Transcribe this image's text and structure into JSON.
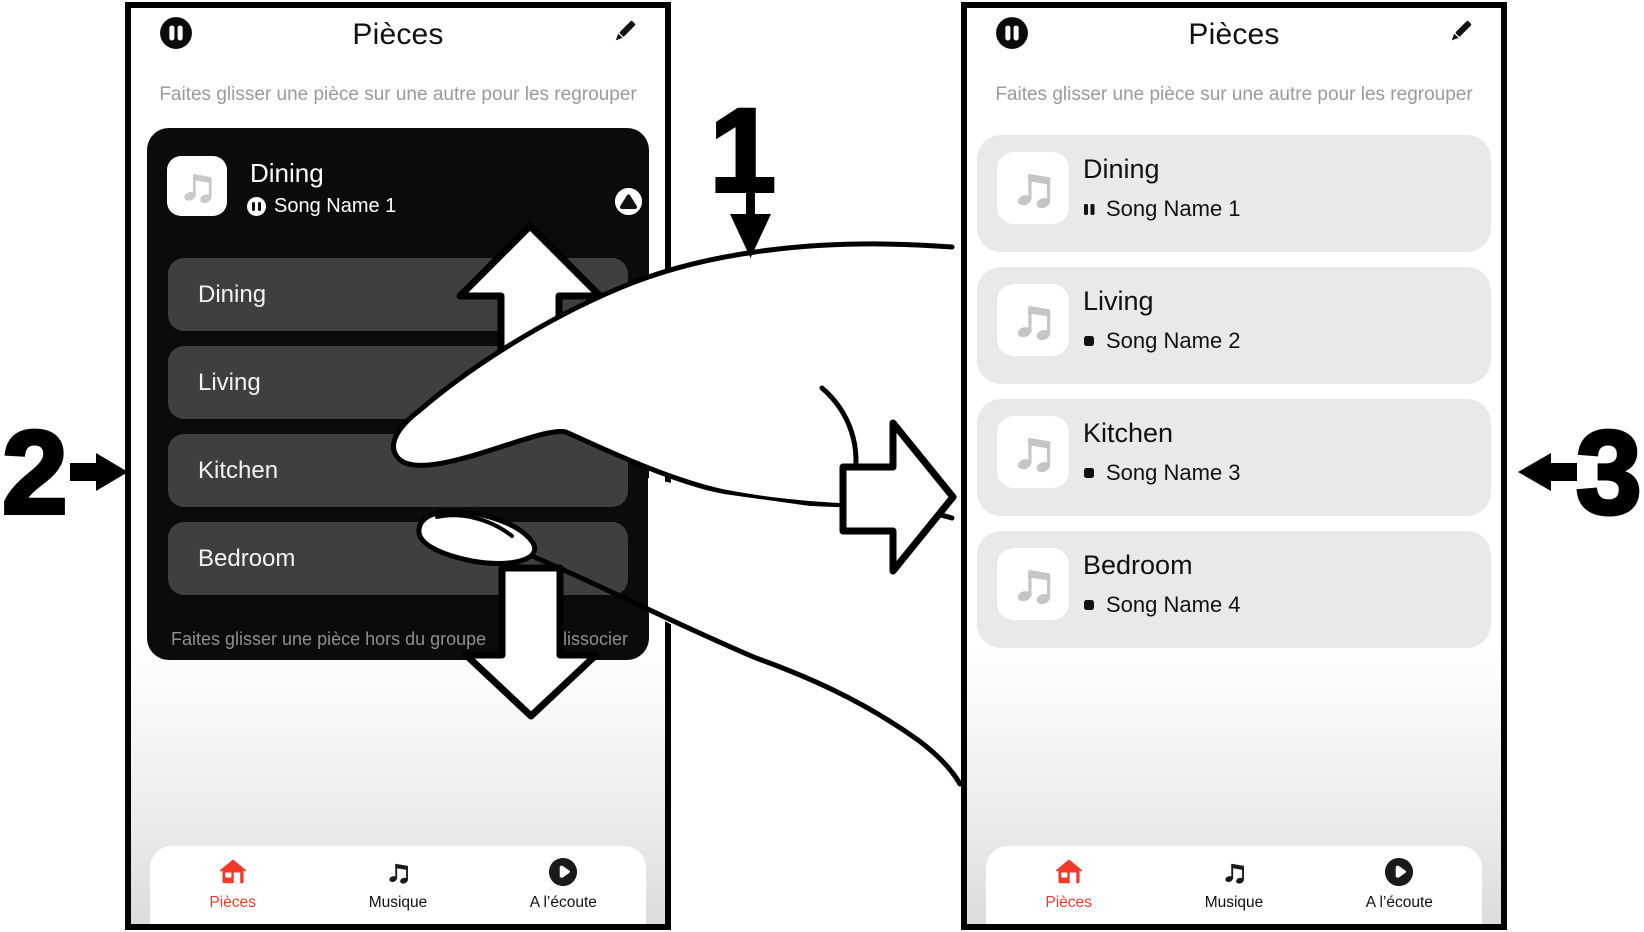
{
  "overlay": {
    "step1": "1",
    "step2": "2",
    "step3": "3"
  },
  "phone_left": {
    "title": "Pièces",
    "subtitle": "Faites glisser une pièce sur une autre pour les regrouper",
    "group_card": {
      "room": "Dining",
      "song": "Song Name 1",
      "rooms": [
        "Dining",
        "Living",
        "Kitchen",
        "Bedroom"
      ],
      "hint_left": "Faites glisser une pièce hors du groupe",
      "hint_right": "lissocier"
    },
    "nav": [
      {
        "label": "Pièces",
        "active": true
      },
      {
        "label": "Musique",
        "active": false
      },
      {
        "label": "A l’écoute",
        "active": false
      }
    ]
  },
  "phone_right": {
    "title": "Pièces",
    "subtitle": "Faites glisser une pièce sur une autre pour les regrouper",
    "rooms": [
      {
        "name": "Dining",
        "song": "Song Name 1",
        "state": "paused"
      },
      {
        "name": "Living",
        "song": "Song Name 2",
        "state": "stopped"
      },
      {
        "name": "Kitchen",
        "song": "Song Name 3",
        "state": "stopped"
      },
      {
        "name": "Bedroom",
        "song": "Song Name 4",
        "state": "stopped"
      }
    ],
    "nav": [
      {
        "label": "Pièces",
        "active": true
      },
      {
        "label": "Musique",
        "active": false
      },
      {
        "label": "A l’écoute",
        "active": false
      }
    ]
  },
  "colors": {
    "accent_red": "#f2392c",
    "dark_card": "#0b0b0b",
    "dark_row": "#3f3f3f",
    "light_card": "#e9e9e9",
    "subtitle_gray": "#9a9a9a"
  }
}
